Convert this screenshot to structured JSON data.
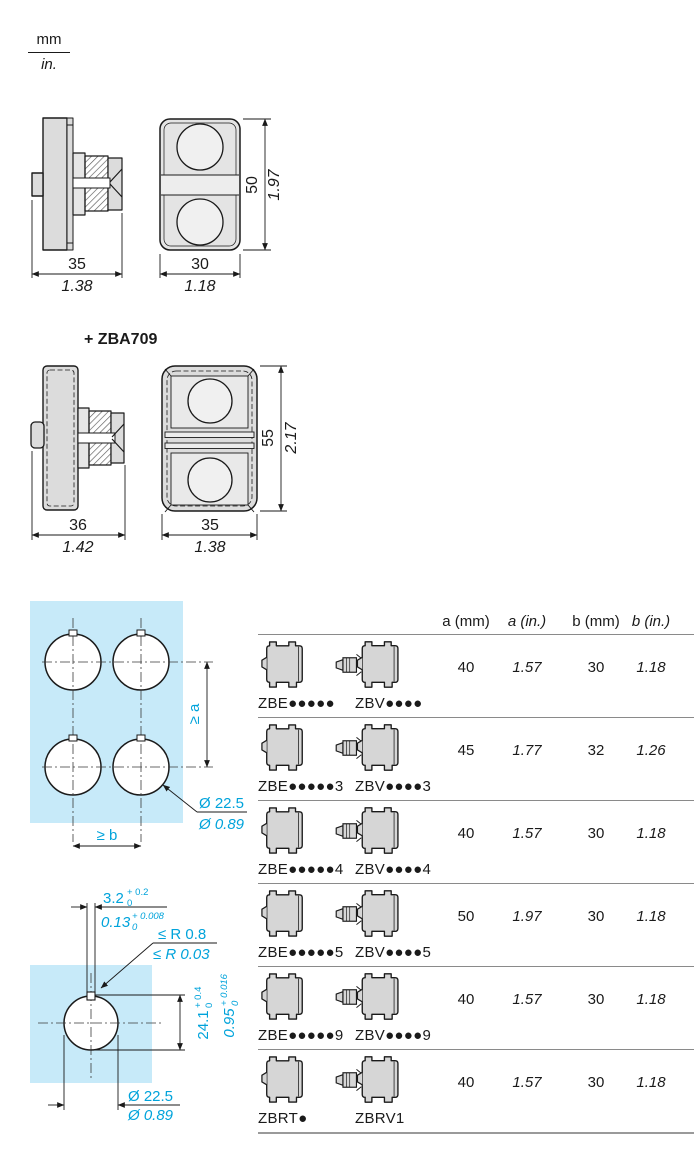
{
  "unit_legend": {
    "mm": "mm",
    "in": "in."
  },
  "fig_double_head": {
    "side": {
      "width_mm": "35",
      "width_in": "1.38"
    },
    "front": {
      "width_mm": "30",
      "width_in": "1.18",
      "height_mm": "50",
      "height_in": "1.97"
    }
  },
  "zba709": {
    "label": "+ ZBA709"
  },
  "fig_double_head_boot": {
    "side": {
      "width_mm": "36",
      "width_in": "1.42"
    },
    "front": {
      "width_mm": "35",
      "width_in": "1.38",
      "height_mm": "55",
      "height_in": "2.17"
    }
  },
  "cutout_multi": {
    "spacing_a": "≥ a",
    "spacing_b": "≥ b",
    "dia_mm": "Ø 22.5",
    "dia_in": "Ø 0.89"
  },
  "cutout_detail": {
    "notch_w_mm": "3.2",
    "notch_w_mm_sup": "+ 0.2",
    "notch_w_mm_sub": "0",
    "notch_w_in": "0.13",
    "notch_w_in_sup": "+ 0.008",
    "notch_w_in_sub": "0",
    "radius_mm": "≤ R 0.8",
    "radius_in": "≤ R 0.03",
    "height_mm": "24.1",
    "height_mm_sup": "+ 0.4",
    "height_mm_sub": "0",
    "height_in": "0.95",
    "height_in_sup": "+ 0.016",
    "height_in_sub": "0",
    "dia_mm": "Ø 22.5",
    "dia_in": "Ø 0.89"
  },
  "table": {
    "headers": [
      "a (mm)",
      "a (in.)",
      "b (mm)",
      "b (in.)"
    ],
    "rows": [
      {
        "left_label": "ZBE●●●●●",
        "right_label": "ZBV●●●●",
        "a_mm": "40",
        "a_in": "1.57",
        "b_mm": "30",
        "b_in": "1.18"
      },
      {
        "left_label": "ZBE●●●●●3",
        "right_label": "ZBV●●●●3",
        "a_mm": "45",
        "a_in": "1.77",
        "b_mm": "32",
        "b_in": "1.26"
      },
      {
        "left_label": "ZBE●●●●●4",
        "right_label": "ZBV●●●●4",
        "a_mm": "40",
        "a_in": "1.57",
        "b_mm": "30",
        "b_in": "1.18"
      },
      {
        "left_label": "ZBE●●●●●5",
        "right_label": "ZBV●●●●5",
        "a_mm": "50",
        "a_in": "1.97",
        "b_mm": "30",
        "b_in": "1.18"
      },
      {
        "left_label": "ZBE●●●●●9",
        "right_label": "ZBV●●●●9",
        "a_mm": "40",
        "a_in": "1.57",
        "b_mm": "30",
        "b_in": "1.18"
      },
      {
        "left_label": "ZBRT●",
        "right_label": "ZBRV1",
        "a_mm": "40",
        "a_in": "1.57",
        "b_mm": "30",
        "b_in": "1.18"
      }
    ]
  },
  "colors": {
    "accent_cyan": "#00A3DB",
    "panel_fill": "#C7EAF9",
    "part_fill": "#D6D6D6",
    "line": "#1a1a1a"
  }
}
